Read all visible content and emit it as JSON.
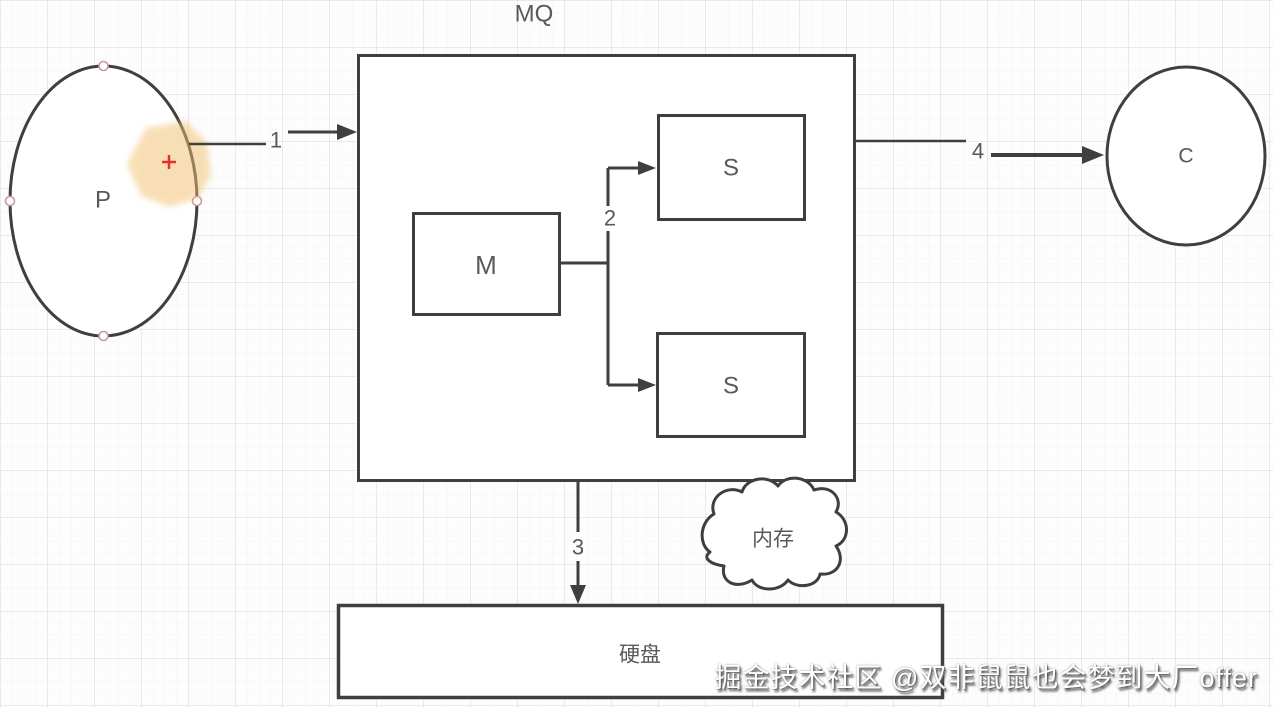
{
  "diagram": {
    "nodes": {
      "mq_container": {
        "label": "MQ"
      },
      "producer": {
        "label": "P"
      },
      "consumer": {
        "label": "C"
      },
      "master": {
        "label": "M"
      },
      "slave_top": {
        "label": "S"
      },
      "slave_bottom": {
        "label": "S"
      },
      "disk": {
        "label": "硬盘"
      },
      "memory": {
        "label": "内存"
      }
    },
    "edges": {
      "step1": {
        "label": "1"
      },
      "step2": {
        "label": "2"
      },
      "step3": {
        "label": "3"
      },
      "step4": {
        "label": "4"
      }
    }
  },
  "annotations": {
    "watermark": "掘金技术社区 @双非鼠鼠也会梦到大厂offer"
  },
  "colors": {
    "shape_stroke": "#3f3f3f",
    "label_text": "#595959",
    "highlight": "#f2bf6e",
    "cursor_cross": "#e03428",
    "handle_ring": "#cb97a2",
    "watermark_text": "#ffffff"
  }
}
